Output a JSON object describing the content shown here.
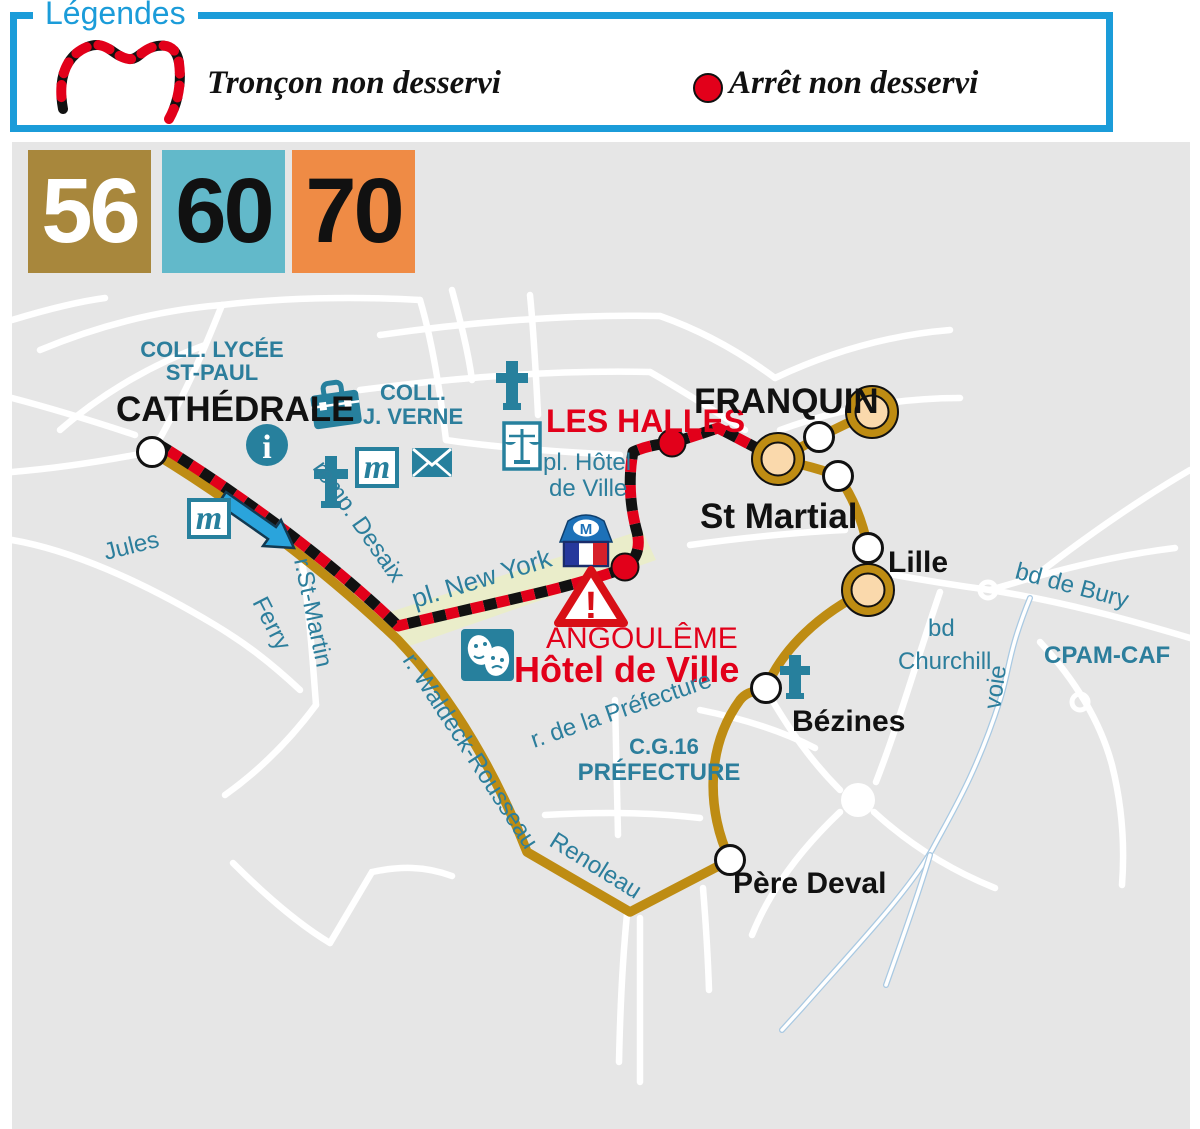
{
  "legend": {
    "title": "Légendes",
    "items": [
      {
        "symbol": "dashed-line",
        "label": "Tronçon non desservi"
      },
      {
        "symbol": "red-dot",
        "label": "Arrêt non desservi"
      }
    ]
  },
  "routes": [
    {
      "number": "56",
      "bg": "#A8873C",
      "text_color": "#FFFFFF"
    },
    {
      "number": "60",
      "bg": "#62B9CA",
      "text_color": "#111111"
    },
    {
      "number": "70",
      "bg": "#EF8B45",
      "text_color": "#111111"
    }
  ],
  "map": {
    "stops": {
      "cathedrale": "CATHÉDRALE",
      "les_halles": "LES HALLES",
      "franquin": "FRANQUIN",
      "st_martial": "St Martial",
      "lille": "Lille",
      "bezines": "Bézines",
      "pere_deval": "Père Deval"
    },
    "city_hall": {
      "city": "ANGOULÊME",
      "name": "Hôtel de Ville"
    },
    "pois": {
      "coll_lycee_1": "COLL. LYCÉE",
      "coll_lycee_2": "ST-PAUL",
      "coll_verne_1": "COLL.",
      "coll_verne_2": "J. VERNE",
      "cg16": "C.G.16",
      "prefecture": "PRÉFECTURE",
      "cpam": "CPAM-CAF"
    },
    "streets": {
      "jules": "Jules",
      "ferry": "Ferry",
      "st_martin": "r.St-Martin",
      "remp_desaix": "remp. Desaix",
      "pl_new_york": "pl. New York",
      "pl_hotel_1": "pl. Hôtel",
      "pl_hotel_2": "de Ville",
      "waldeck": "r.  Waldeck-Rousseau",
      "renoleau": "Renoleau",
      "rue_prefecture": "r. de la Préfecture",
      "bd_bury": "bd de Bury",
      "bd_churchill_1": "bd",
      "bd_churchill_2": "Churchill",
      "voie": "voie"
    },
    "glyphs": {
      "info_letter": "i",
      "museum_letter": "m",
      "town_hall_letter": "M",
      "warning_mark": "!"
    },
    "icons": [
      "info-icon",
      "school-bag-icon",
      "church-cross-icon",
      "museum-m-icon",
      "post-envelope-icon",
      "justice-scales-icon",
      "theater-masks-icon",
      "town-hall-icon",
      "warning-triangle-icon",
      "direction-arrow-icon"
    ],
    "colors": {
      "route_gold": "#BE8C13",
      "stop_ring_fill": "#FAD9AC",
      "legend_blue": "#1B9CD9",
      "label_teal": "#2C7E9C",
      "icon_teal": "#27809D",
      "alert_red": "#E2001A",
      "map_bg": "#E6E6E6",
      "place_band": "#EAEDCA"
    }
  }
}
